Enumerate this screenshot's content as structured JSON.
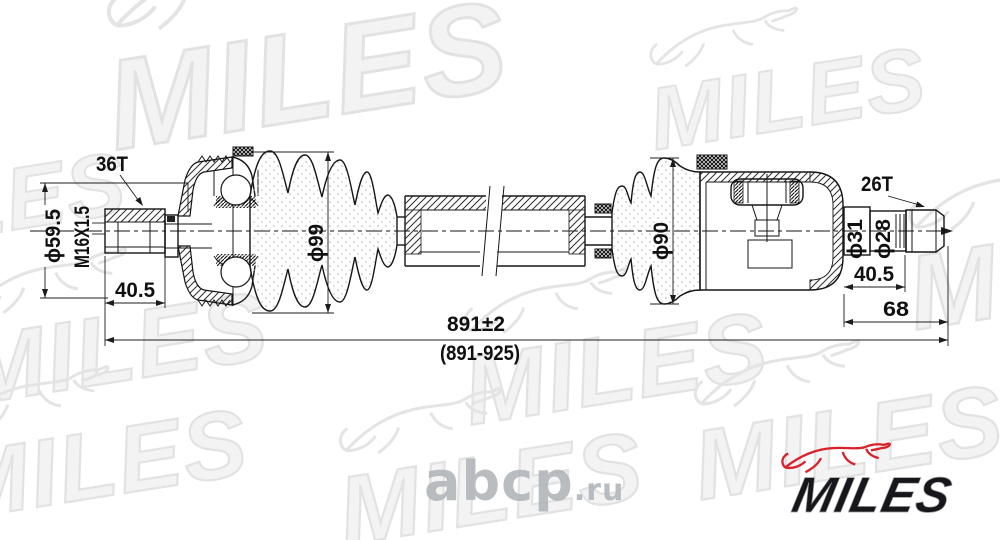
{
  "watermark": {
    "brand": "MILES",
    "site_name": "abcp",
    "site_tld": ".ru"
  },
  "logo": {
    "brand": "MILES",
    "dog_color": "#d8232a",
    "text_color": "#17171b"
  },
  "colors": {
    "line": "#161616",
    "watermark_fill": "#f3f3f3",
    "watermark_stroke": "#e2e2e2",
    "site_watermark": "#b2b6ba"
  },
  "dimensions": {
    "outer_spline_teeth": "36T",
    "outer_hub_dia": "ϕ59.5",
    "thread_spec": "M16X1.5",
    "outer_stub_length": "40.5",
    "outer_boot_dia": "ϕ99",
    "total_length": "891±2",
    "total_length_range": "(891-925)",
    "inner_boot_dia": "ϕ90",
    "inner_spline_teeth": "26T",
    "inner_stub_dia_outer": "ϕ31",
    "inner_stub_dia_inner": "ϕ28",
    "inner_stub_length": "40.5",
    "inner_joint_length": "68"
  }
}
